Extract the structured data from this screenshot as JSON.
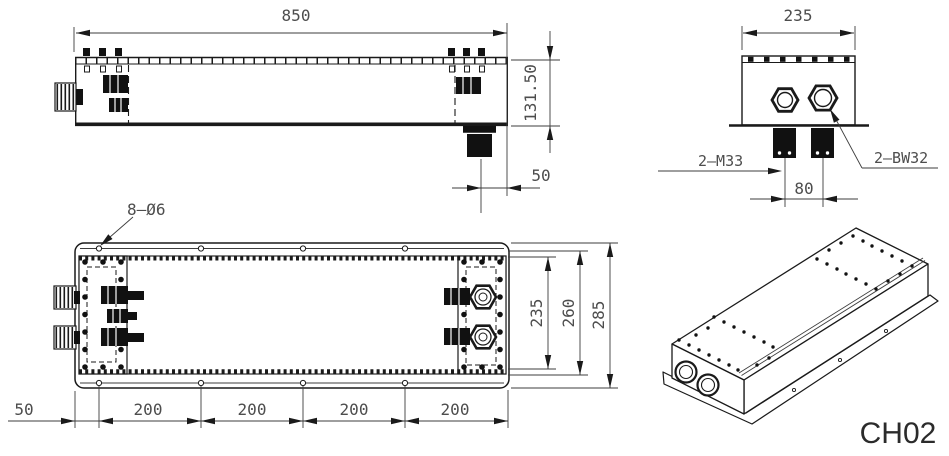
{
  "drawing_code": "CH02",
  "colors": {
    "line": "#1a1a1a",
    "dim": "#4d4d4d"
  },
  "side_view": {
    "length": "850",
    "height": "131.50",
    "port_offset": "50"
  },
  "end_view": {
    "width": "235",
    "left_glands": "2–M33",
    "right_glands": "2–BW32",
    "gland_pitch": "80"
  },
  "plan_view": {
    "holes_callout": "8–Ø6",
    "bolt_field_width": "235",
    "body_width": "260",
    "flange_width": "285",
    "edge_to_first_hole": "50",
    "hole_pitch": [
      "200",
      "200",
      "200",
      "200"
    ]
  }
}
